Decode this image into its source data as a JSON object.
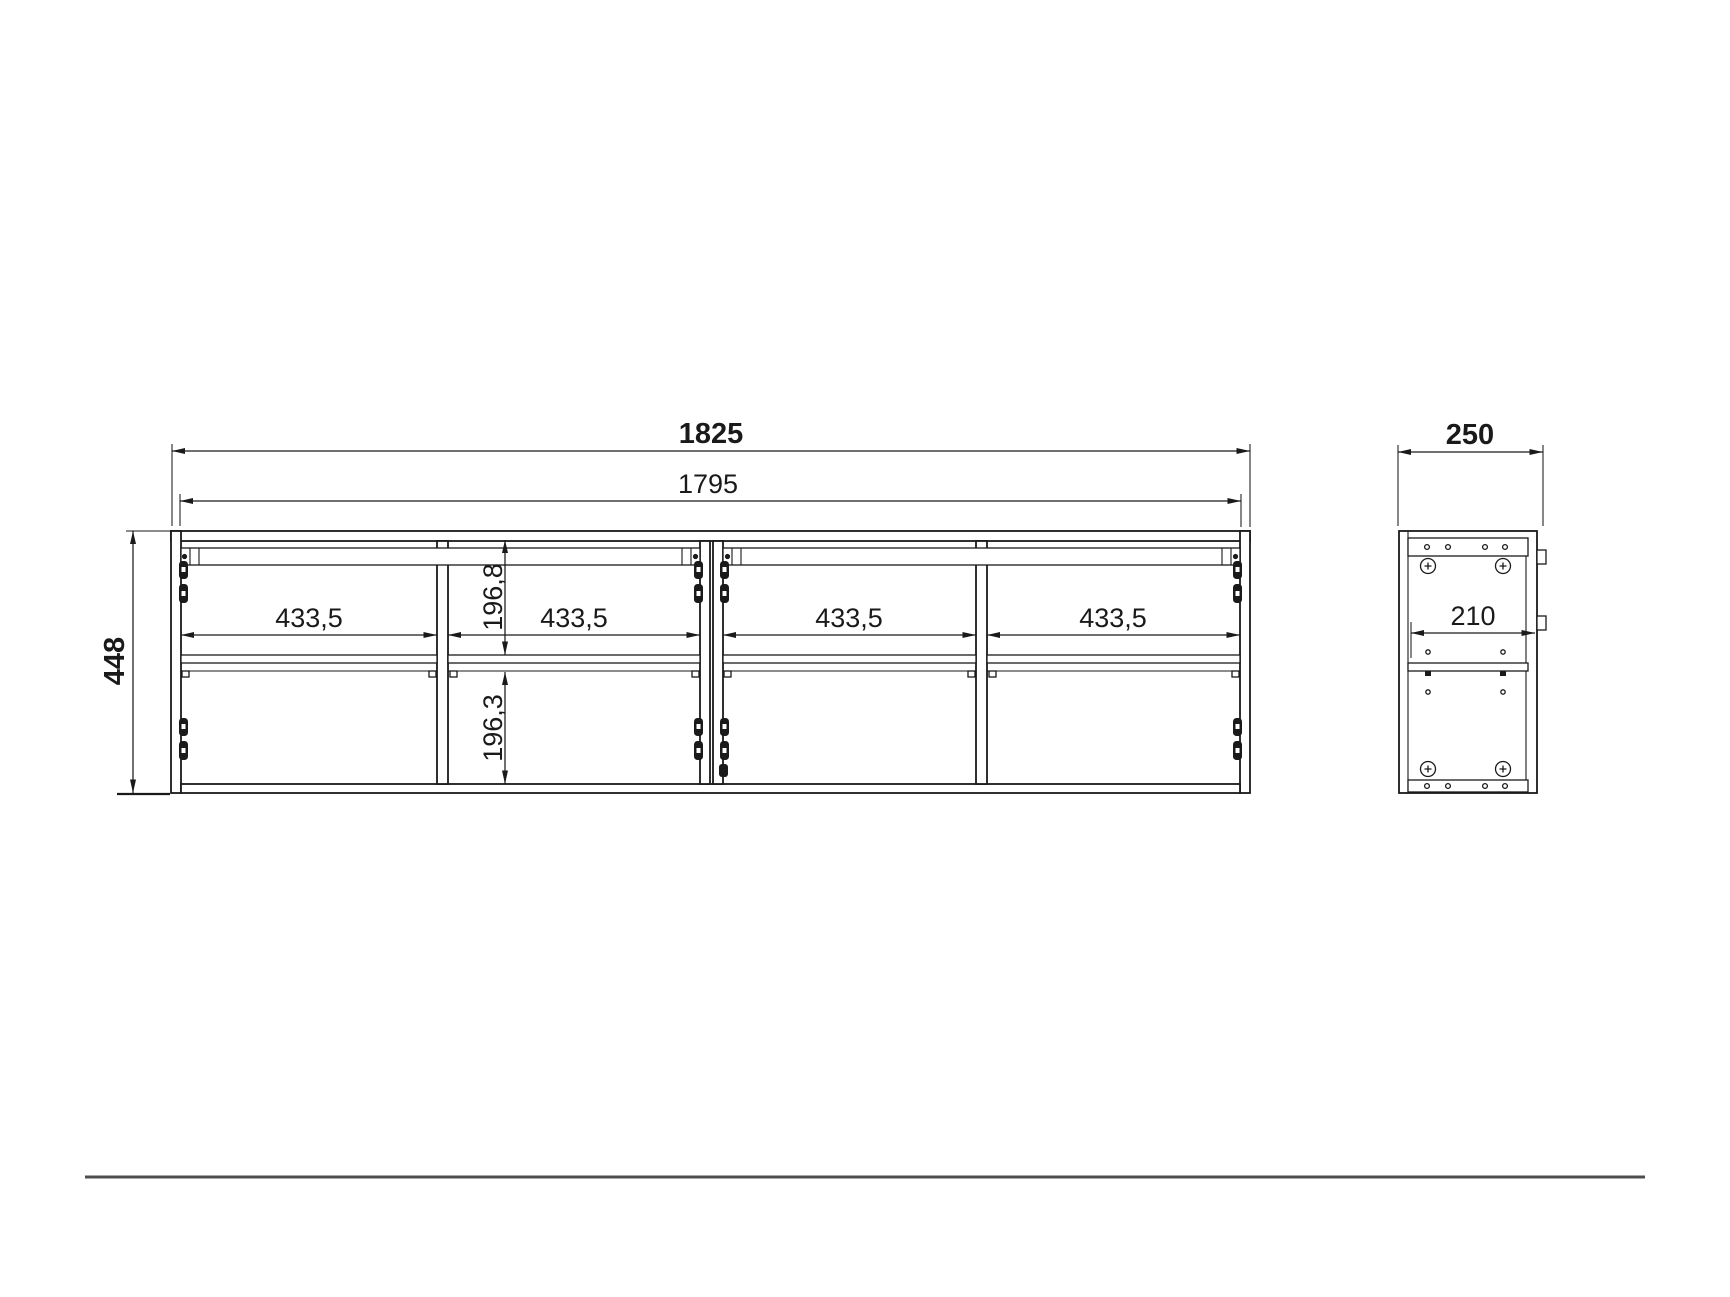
{
  "drawing_title": "wall-cabinet-dimension-drawing",
  "front_view": {
    "total_width": "1825",
    "inner_width": "1795",
    "height": "448",
    "compartment_widths": [
      "433,5",
      "433,5",
      "433,5",
      "433,5"
    ],
    "upper_compartment_height": "196,8",
    "lower_compartment_height": "196,3"
  },
  "side_view": {
    "depth": "250",
    "inner_depth": "210"
  },
  "colors": {
    "line": "#1a1a1a",
    "ground_line": "#4d4d4d",
    "background": "#ffffff"
  }
}
